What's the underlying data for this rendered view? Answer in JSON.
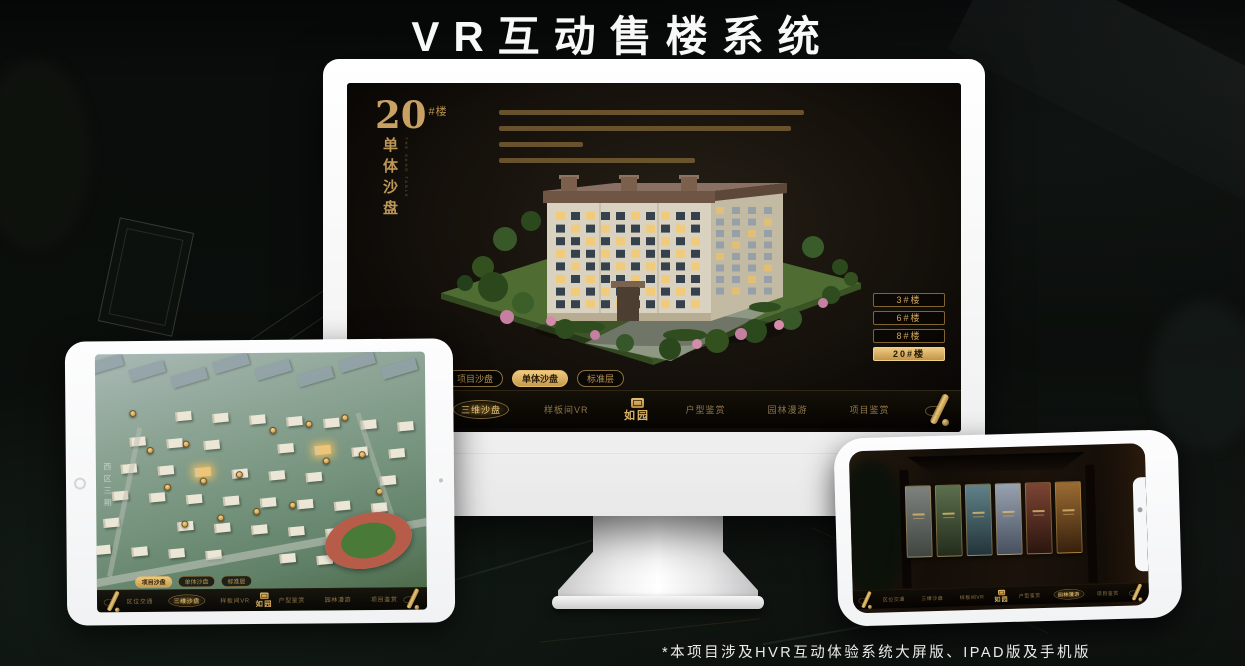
{
  "page": {
    "title": "VR互动售楼系统",
    "footnote": "*本项目涉及HVR互动体验系统大屏版、IPAD版及手机版"
  },
  "brand": {
    "logo_text": "如园",
    "accent_gold": "#c9a463",
    "active_gold": "#eecb80"
  },
  "monitor_app": {
    "headline": {
      "number": "20",
      "suffix": "#楼",
      "vertical_title": "单体沙盘",
      "vertical_subtitle": "THE SAND TABLE"
    },
    "floor_buttons": [
      {
        "label": "3#楼",
        "active": false
      },
      {
        "label": "6#楼",
        "active": false
      },
      {
        "label": "8#楼",
        "active": false
      },
      {
        "label": "20#楼",
        "active": true
      }
    ],
    "view_tabs": [
      {
        "label": "项目沙盘",
        "active": false
      },
      {
        "label": "单体沙盘",
        "active": true
      },
      {
        "label": "标准层",
        "active": false
      }
    ],
    "nav_items": [
      {
        "label": "区位交通",
        "active": false
      },
      {
        "label": "三维沙盘",
        "active": true
      },
      {
        "label": "样板间VR",
        "active": false
      },
      {
        "label": "户型鉴赏",
        "active": false
      },
      {
        "label": "园林漫游",
        "active": false
      },
      {
        "label": "项目鉴赏",
        "active": false
      }
    ]
  },
  "tablet_app": {
    "region_label": "西区三期",
    "view_tabs": [
      {
        "label": "项目沙盘",
        "active": true
      },
      {
        "label": "单体沙盘",
        "active": false
      },
      {
        "label": "标准层",
        "active": false
      }
    ],
    "nav_items": [
      {
        "label": "区位交通",
        "active": false
      },
      {
        "label": "三维沙盘",
        "active": true
      },
      {
        "label": "样板间VR",
        "active": false
      },
      {
        "label": "户型鉴赏",
        "active": false
      },
      {
        "label": "园林漫游",
        "active": false
      },
      {
        "label": "项目鉴赏",
        "active": false
      }
    ]
  },
  "phone_app": {
    "nav_items": [
      {
        "label": "区位交通",
        "active": false
      },
      {
        "label": "三维沙盘",
        "active": false
      },
      {
        "label": "样板间VR",
        "active": false
      },
      {
        "label": "户型鉴赏",
        "active": false
      },
      {
        "label": "园林漫游",
        "active": true
      },
      {
        "label": "项目鉴赏",
        "active": false
      }
    ]
  }
}
